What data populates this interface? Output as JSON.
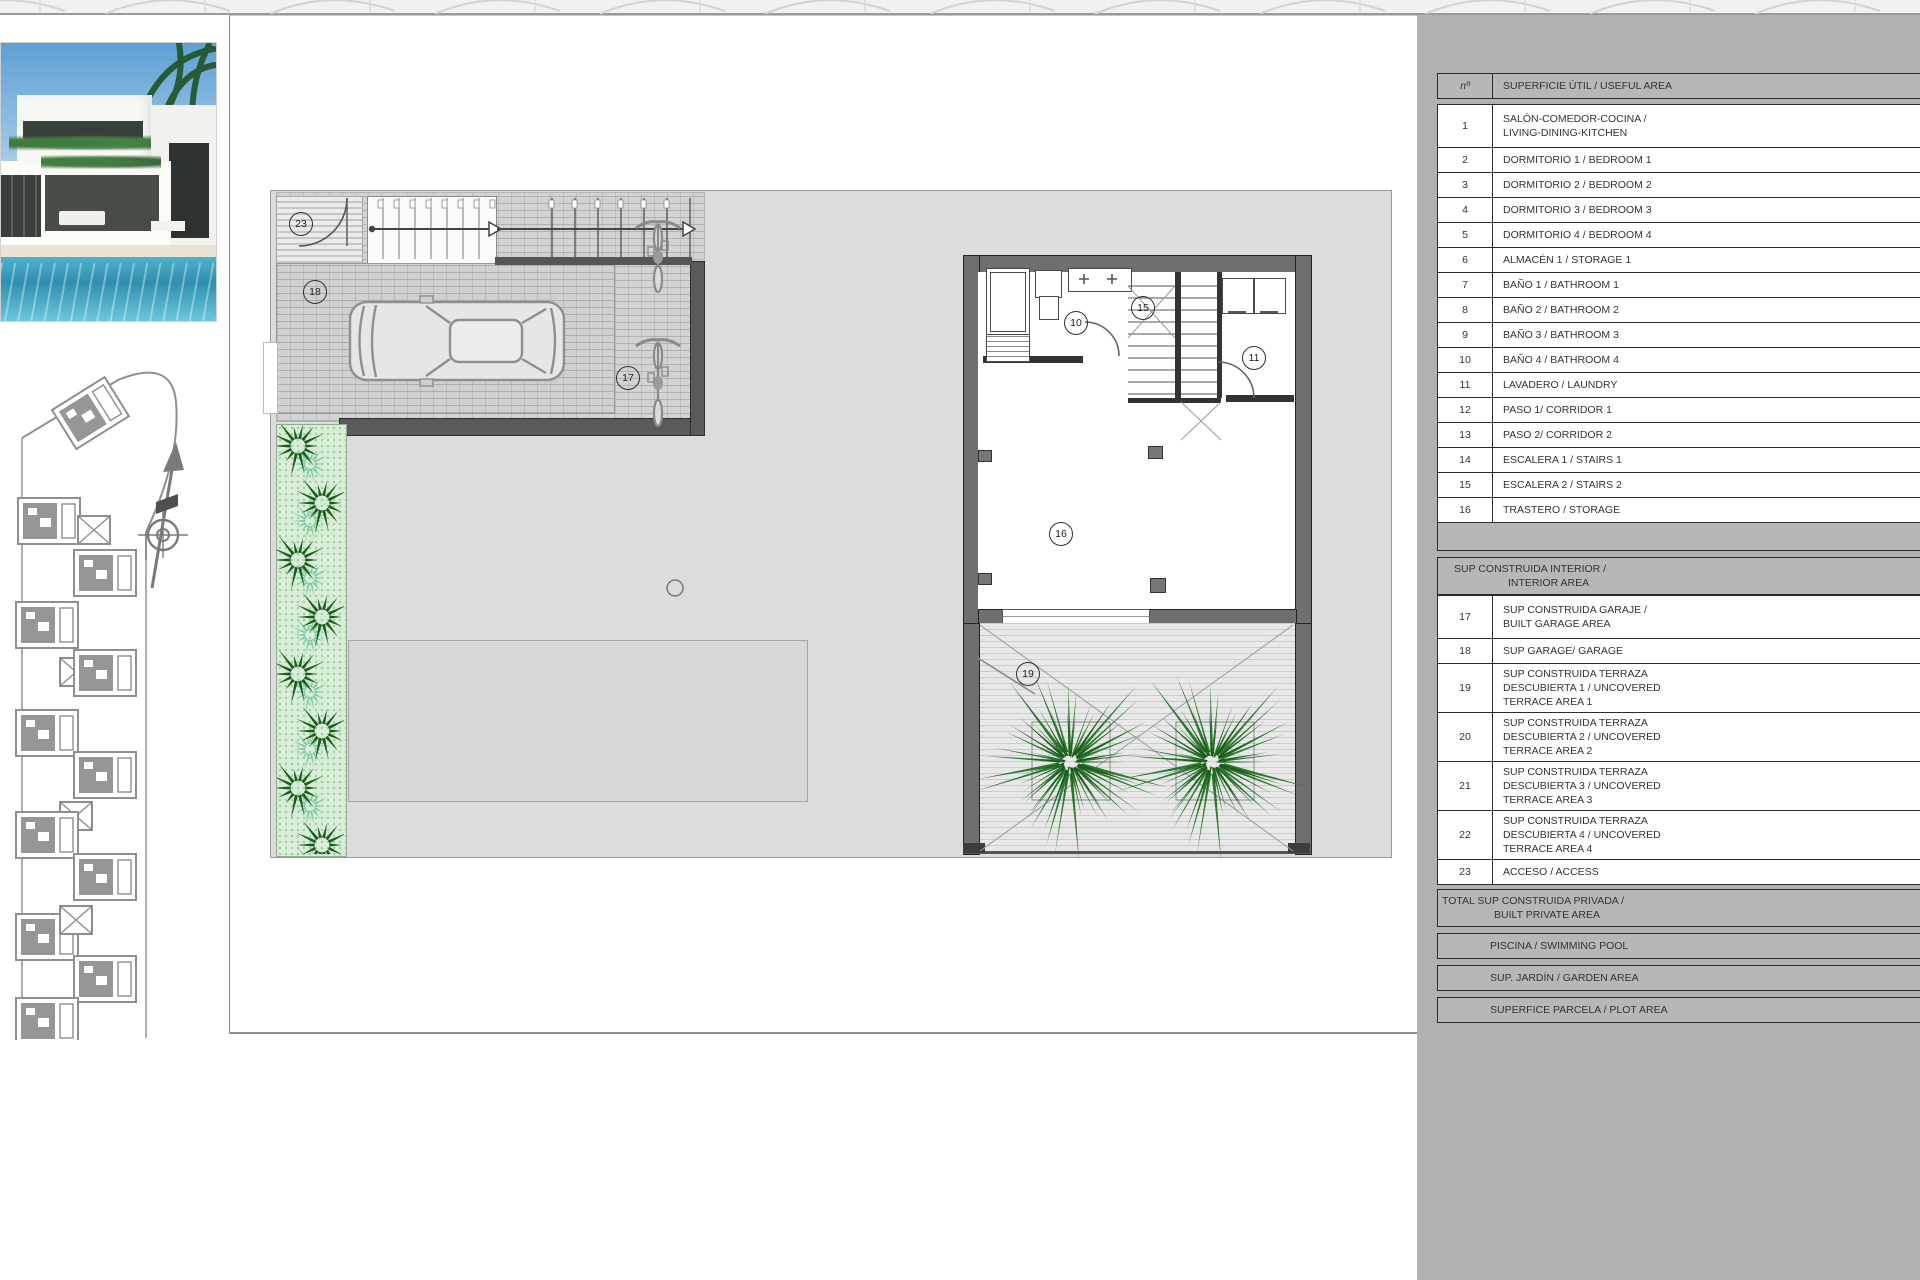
{
  "plan": {
    "room_labels": [
      "23",
      "18",
      "17",
      "10",
      "15",
      "11",
      "16",
      "19"
    ]
  },
  "panel": {
    "header": {
      "num": "nº",
      "title": "SUPERFICIE ÚTIL / USEFUL AREA"
    },
    "rooms": [
      {
        "num": "1",
        "lines": [
          "SALÓN-COMEDOR-COCINA /",
          "LIVING-DINING-KITCHEN"
        ]
      },
      {
        "num": "2",
        "lines": [
          "DORMITORIO 1 / BEDROOM 1"
        ]
      },
      {
        "num": "3",
        "lines": [
          "DORMITORIO 2 / BEDROOM 2"
        ]
      },
      {
        "num": "4",
        "lines": [
          "DORMITORIO 3 / BEDROOM 3"
        ]
      },
      {
        "num": "5",
        "lines": [
          "DORMITORIO 4 / BEDROOM 4"
        ]
      },
      {
        "num": "6",
        "lines": [
          "ALMACÉN 1 / STORAGE 1"
        ]
      },
      {
        "num": "7",
        "lines": [
          "BAÑO 1 / BATHROOM 1"
        ]
      },
      {
        "num": "8",
        "lines": [
          "BAÑO 2 / BATHROOM 2"
        ]
      },
      {
        "num": "9",
        "lines": [
          "BAÑO 3 / BATHROOM 3"
        ]
      },
      {
        "num": "10",
        "lines": [
          "BAÑO 4 / BATHROOM 4"
        ]
      },
      {
        "num": "11",
        "lines": [
          "LAVADERO / LAUNDRY"
        ]
      },
      {
        "num": "12",
        "lines": [
          "PASO 1/ CORRIDOR 1"
        ]
      },
      {
        "num": "13",
        "lines": [
          "PASO 2/ CORRIDOR 2"
        ]
      },
      {
        "num": "14",
        "lines": [
          "ESCALERA 1 / STAIRS 1"
        ]
      },
      {
        "num": "15",
        "lines": [
          "ESCALERA 2 / STAIRS 2"
        ]
      },
      {
        "num": "16",
        "lines": [
          "TRASTERO / STORAGE"
        ]
      }
    ],
    "section2": {
      "lines": [
        "SUP CONSTRUIDA INTERIOR /",
        "INTERIOR AREA"
      ]
    },
    "areas": [
      {
        "num": "17",
        "lines": [
          "SUP CONSTRUIDA GARAJE /",
          "BUILT GARAGE AREA"
        ]
      },
      {
        "num": "18",
        "lines": [
          "SUP GARAGE/ GARAGE"
        ]
      },
      {
        "num": "19",
        "lines": [
          "SUP CONSTRUIDA TERRAZA",
          "DESCUBIERTA 1 / UNCOVERED",
          "TERRACE AREA 1"
        ]
      },
      {
        "num": "20",
        "lines": [
          "SUP CONSTRUIDA TERRAZA",
          "DESCUBIERTA 2 / UNCOVERED",
          "TERRACE AREA 2"
        ]
      },
      {
        "num": "21",
        "lines": [
          "SUP CONSTRUIDA TERRAZA",
          "DESCUBIERTA 3 / UNCOVERED",
          "TERRACE AREA 3"
        ]
      },
      {
        "num": "22",
        "lines": [
          "SUP CONSTRUIDA TERRAZA",
          "DESCUBIERTA 4 / UNCOVERED",
          "TERRACE AREA 4"
        ]
      },
      {
        "num": "23",
        "lines": [
          "ACCESO / ACCESS"
        ]
      }
    ],
    "total": {
      "lines": [
        "TOTAL SUP CONSTRUIDA PRIVADA /",
        "BUILT PRIVATE AREA"
      ]
    },
    "footers": [
      "PISCINA / SWIMMING POOL",
      "SUP. JARDÍN / GARDEN AREA",
      "SUPERFICE PARCELA / PLOT AREA"
    ]
  },
  "colors": {
    "panel_bg": "#b1b1b1",
    "parcel": "#dcdcdc",
    "wall": "#6f6f6f",
    "wall_dark": "#5a5a5a",
    "hedge_bg": "#d8edd8",
    "shrub_green": "#1e5c1e",
    "palm_green": "#2c7a2f",
    "teal_accent": "#7cc9a5",
    "deck_stripe": "#cccccc",
    "pool_blue": "#37a0bf",
    "sky_blue": "#5e9fd4"
  }
}
